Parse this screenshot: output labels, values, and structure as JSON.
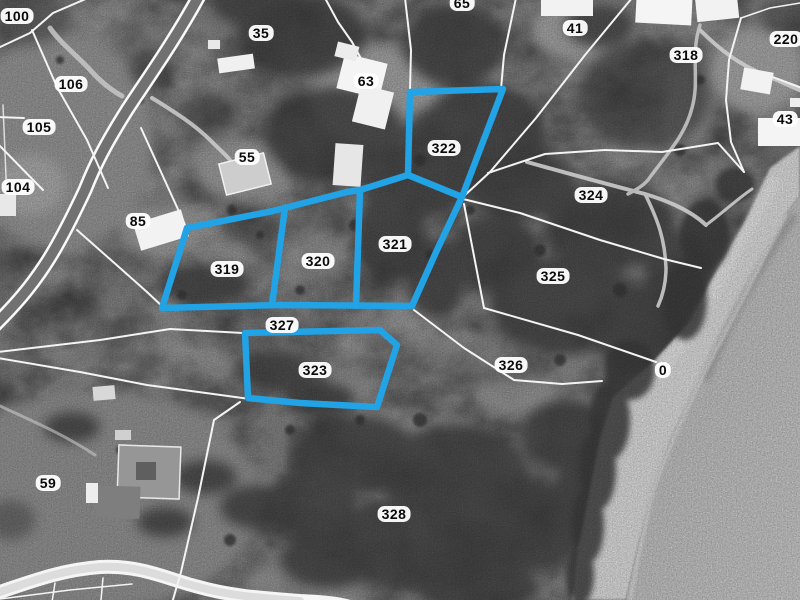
{
  "map": {
    "highlight_color": "#21A3E5",
    "boundary_color": "#F4F4F4",
    "selected_parcels": [
      "319",
      "320",
      "321",
      "322",
      "323"
    ],
    "labels": [
      {
        "text": "100"
      },
      {
        "text": "35"
      },
      {
        "text": "65"
      },
      {
        "text": "41"
      },
      {
        "text": "318"
      },
      {
        "text": "220"
      },
      {
        "text": "106"
      },
      {
        "text": "63"
      },
      {
        "text": "105"
      },
      {
        "text": "43"
      },
      {
        "text": "55"
      },
      {
        "text": "104"
      },
      {
        "text": "324"
      },
      {
        "text": "85"
      },
      {
        "text": "322"
      },
      {
        "text": "321"
      },
      {
        "text": "319"
      },
      {
        "text": "320"
      },
      {
        "text": "325"
      },
      {
        "text": "327"
      },
      {
        "text": "323"
      },
      {
        "text": "326"
      },
      {
        "text": "0"
      },
      {
        "text": "59"
      },
      {
        "text": "328"
      }
    ]
  }
}
